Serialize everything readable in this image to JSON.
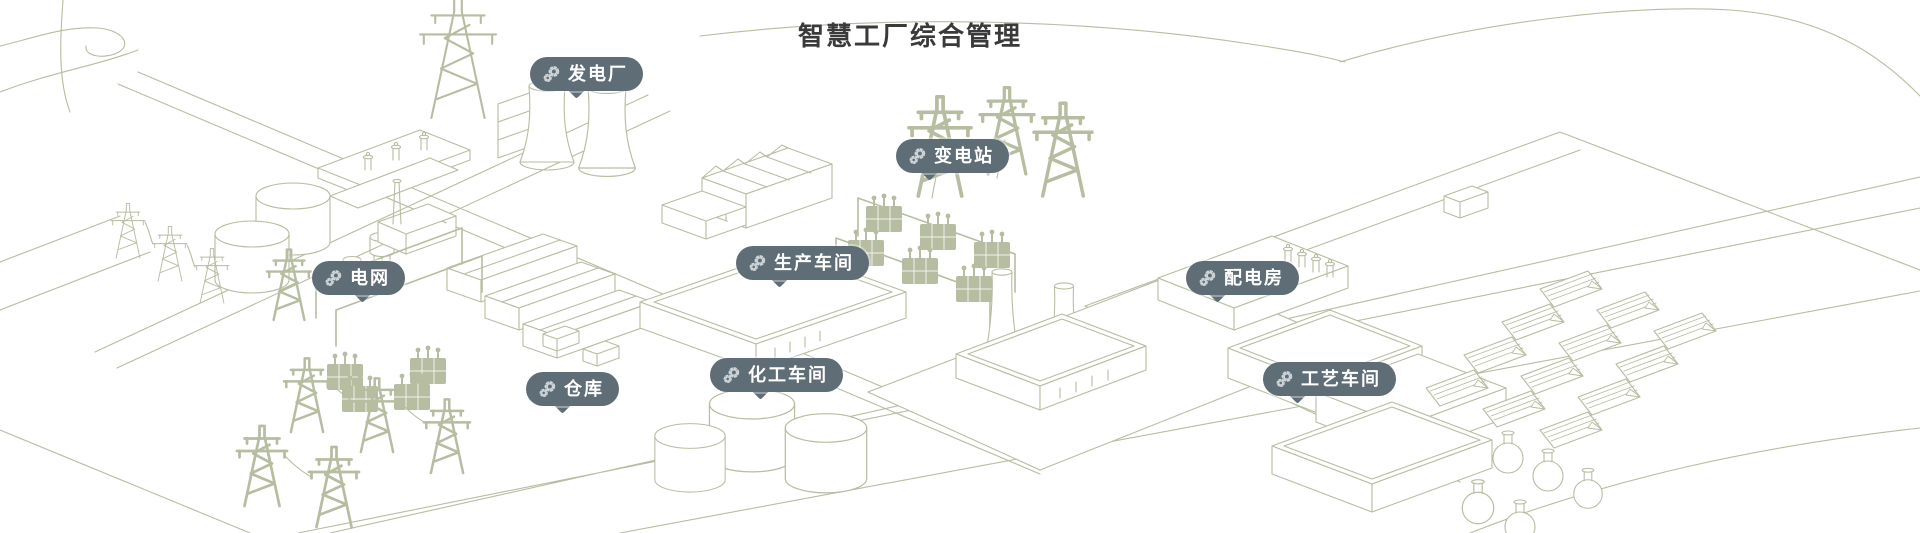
{
  "title": "智慧工厂综合管理",
  "colors": {
    "background": "#ffffff",
    "illustration_line": "#b6bda1",
    "pill_background": "#5f6d77",
    "pill_text": "#ffffff",
    "title_text": "#3a3a3a",
    "pill_icon": "#ced5d8"
  },
  "pins": [
    {
      "id": "power-plant",
      "label": "发电厂",
      "icon": "gears-icon",
      "x": 530,
      "y": 57,
      "tail_x": 0.42
    },
    {
      "id": "substation",
      "label": "变电站",
      "icon": "gears-icon",
      "x": 896,
      "y": 139,
      "tail_x": 0.3
    },
    {
      "id": "power-grid",
      "label": "电网",
      "icon": "gears-icon",
      "x": 312,
      "y": 261,
      "tail_x": 0.55
    },
    {
      "id": "production-workshop",
      "label": "生产车间",
      "icon": "gears-icon",
      "x": 736,
      "y": 246,
      "tail_x": 0.33
    },
    {
      "id": "distribution-room",
      "label": "配电房",
      "icon": "gears-icon",
      "x": 1186,
      "y": 261,
      "tail_x": 0.28
    },
    {
      "id": "warehouse",
      "label": "仓库",
      "icon": "gears-icon",
      "x": 526,
      "y": 372,
      "tail_x": 0.4
    },
    {
      "id": "chemical-workshop",
      "label": "化工车间",
      "icon": "gears-icon",
      "x": 710,
      "y": 358,
      "tail_x": 0.38
    },
    {
      "id": "process-workshop",
      "label": "工艺车间",
      "icon": "gears-icon",
      "x": 1263,
      "y": 362,
      "tail_x": 0.26
    }
  ]
}
